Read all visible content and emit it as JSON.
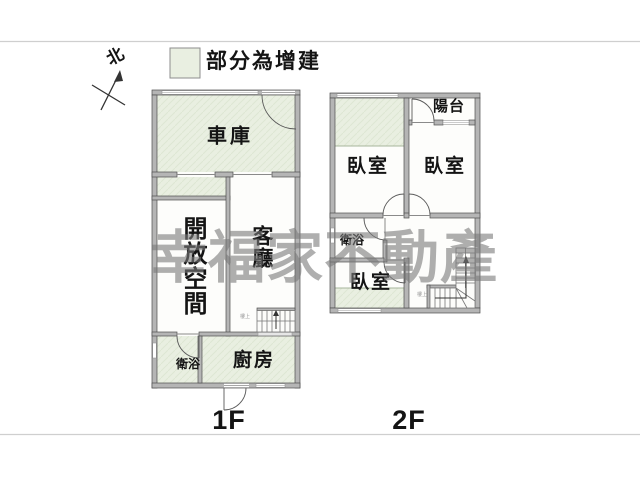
{
  "legend": {
    "label": "部分為增建"
  },
  "compass": {
    "label": "北"
  },
  "watermark": {
    "text": "幸福家不動產"
  },
  "floor1": {
    "label": "1F",
    "rooms": {
      "garage": "車庫",
      "open_space": "開放空間",
      "living_room": "客廳",
      "bathroom": "衛浴",
      "kitchen": "廚房"
    },
    "stair_note": "樓上"
  },
  "floor2": {
    "label": "2F",
    "rooms": {
      "bedroom_top_left": "臥室",
      "bedroom_top_right": "臥室",
      "balcony": "陽台",
      "bathroom": "衛浴",
      "bedroom_bottom": "臥室"
    },
    "stair_note": "樓上"
  },
  "colors": {
    "addition_fill": "#e9efe1",
    "wall_fill": "#b5b5b5",
    "wall_edge": "#4f4f4f",
    "watermark_gray": "#7a7a7a",
    "rule_gray": "#cfcfcf"
  }
}
